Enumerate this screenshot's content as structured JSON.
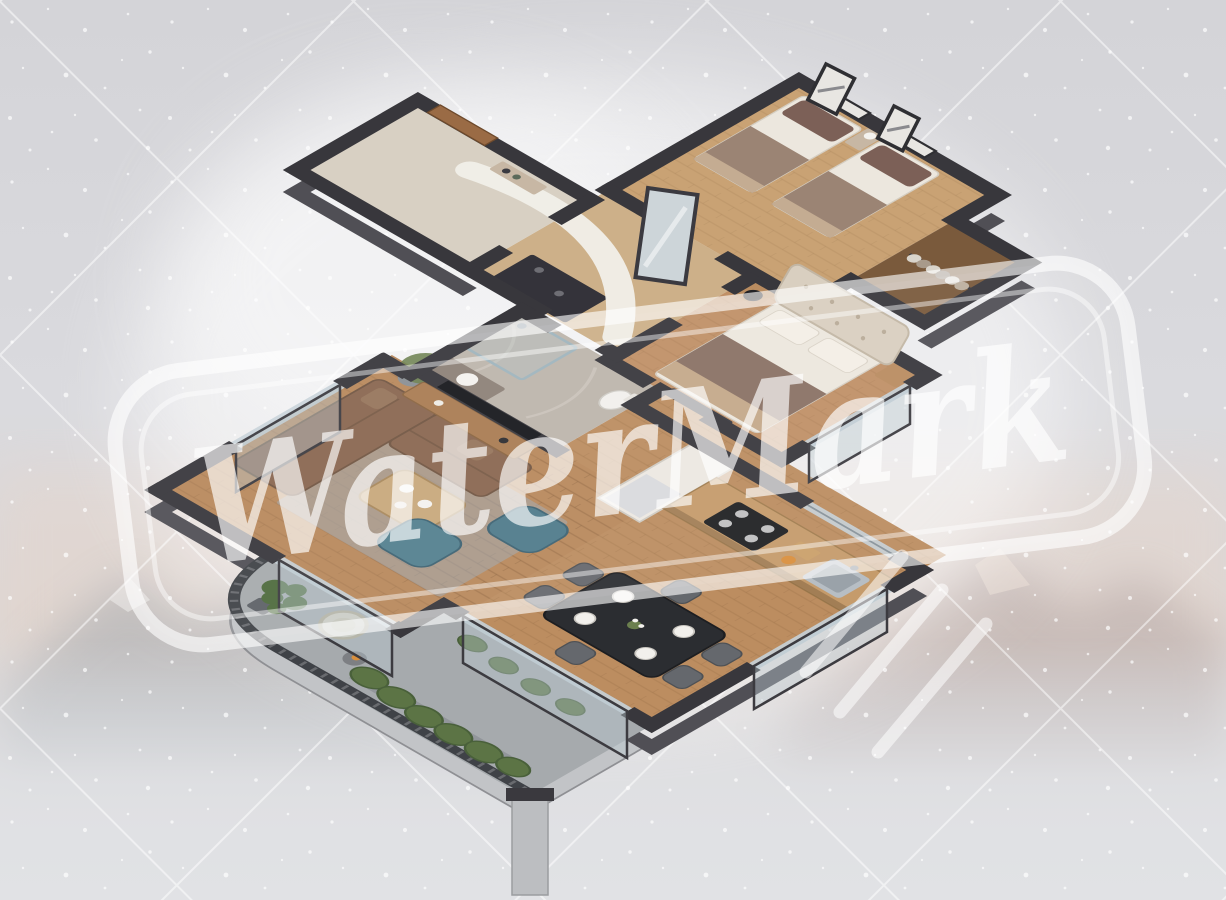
{
  "meta": {
    "description": "3D isometric cut-away floor plan render of a furnished apartment, viewed from above, on a washed-out mountain backdrop with diagonal grid lines and white speckles",
    "projection": "isometric dollhouse cutaway"
  },
  "watermark": {
    "text": "WaterMark",
    "color": "#ffffff",
    "style": "rounded-rectangle double-border stamp with brush flourish strokes",
    "rotation_deg": -7
  },
  "background": {
    "base_top": "#d4d4d8",
    "base_mid": "#dadade",
    "base_bottom": "#e2e3e6",
    "diagonal_grid_color": "#ffffff",
    "speckle_color": "#ffffff",
    "alpenglow": "#e9d5c9",
    "mountain_left": "#8d98a1",
    "mountain_right": "#a89a99",
    "halo": "#ffffff"
  },
  "palette": {
    "wall_cut": "#38373c",
    "wall_face": "#504f55",
    "floor_wood": "#ba8a5e",
    "floor_wood_light": "#c9a274",
    "floor_stone_entrance": "#d8d0c3",
    "floor_marble_bath": "#bdb5ac",
    "balcony_floor": "#a6aaad",
    "glass": "#c6d1d8",
    "sofa_brown": "#8a6750",
    "armchair_teal": "#4f7b8b",
    "rug_gray": "#9fa8b0",
    "bed_linen": "#ece7de",
    "pillow_mauve": "#7c6057",
    "blanket_brown": "#8a7164",
    "headboard_tufted": "#d9cfc0",
    "dining_table_black": "#2b2d31",
    "chair_gray": "#65686d",
    "counter_wood": "#c59b6b",
    "cooktop_black": "#1f2023",
    "cabinet_white": "#ece8e2",
    "door_wood": "#9a6b45",
    "railing_dark": "#3f4247",
    "plant_green": "#5c7445",
    "pillar_gray": "#bcbec1",
    "tv_black": "#17181c",
    "console_wood": "#a97c52"
  },
  "apartment": {
    "rooms": [
      {
        "id": "entrance-hall",
        "label": "Entrance hall",
        "furniture": [
          "wooden entry door",
          "console shelf"
        ]
      },
      {
        "id": "hallway",
        "label": "Hallway",
        "furniture": [
          "curved white wall",
          "wall mirror",
          "dark storage unit"
        ]
      },
      {
        "id": "twin-bedroom",
        "label": "Twin bedroom",
        "furniture": [
          "two single beds with mauve pillows",
          "shared nightstand with lamp",
          "two framed artworks"
        ]
      },
      {
        "id": "wardrobe",
        "label": "Open wardrobe nook",
        "furniture": [
          "hanging clothes on rod"
        ]
      },
      {
        "id": "master-bedroom",
        "label": "Master bedroom",
        "furniture": [
          "double bed",
          "tufted headboard",
          "two nightstands",
          "black table lamp",
          "foot bench"
        ]
      },
      {
        "id": "bathroom",
        "label": "Bathroom",
        "furniture": [
          "walk-in glass shower",
          "toilet",
          "vanity with basin",
          "marble tiling"
        ]
      },
      {
        "id": "living-room",
        "label": "Living room",
        "furniture": [
          "brown corner sofa",
          "two teal armchairs",
          "wooden coffee table",
          "gray area rug",
          "TV media wall",
          "olive tree in pot"
        ]
      },
      {
        "id": "kitchen",
        "label": "Kitchen",
        "furniture": [
          "wood countertop",
          "black cooktop with four burners",
          "steel sink",
          "tall white cabinet with fridge"
        ]
      },
      {
        "id": "dining-area",
        "label": "Dining area",
        "furniture": [
          "black dining table",
          "six gray chairs",
          "white place settings",
          "flower centerpiece"
        ]
      },
      {
        "id": "balcony",
        "label": "Balcony",
        "furniture": [
          "curved chevron metal railing",
          "monstera plant",
          "round lounge chair",
          "side table with fruit",
          "hedge planters",
          "concrete support pillar"
        ]
      }
    ]
  }
}
